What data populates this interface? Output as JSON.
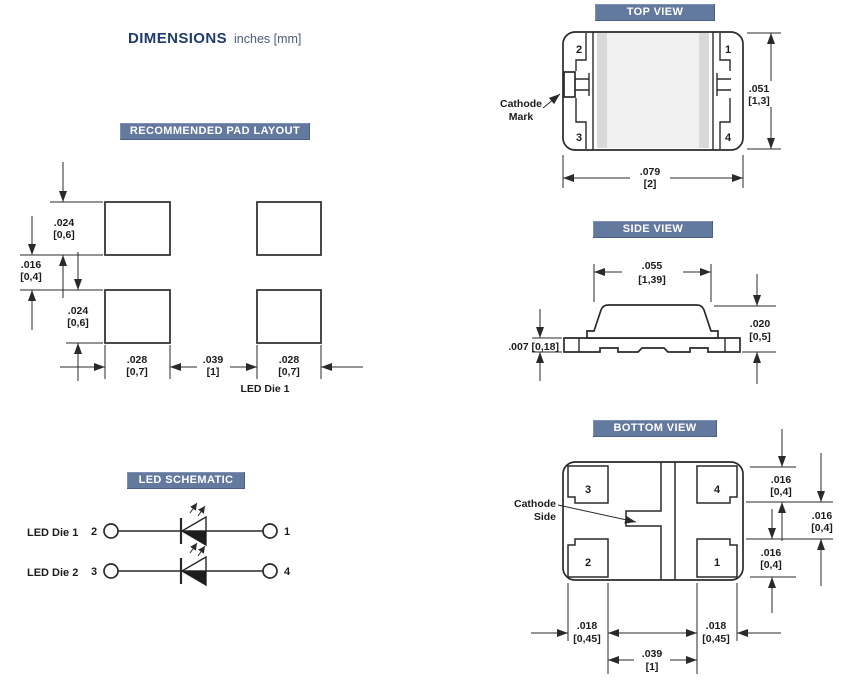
{
  "title": {
    "main": "DIMENSIONS",
    "sub": "inches [mm]"
  },
  "colors": {
    "badge_bg": "#64799e",
    "badge_text": "#ffffff",
    "title_main": "#1e3c6e",
    "title_sub": "#4a5d7a",
    "line_art": "#2a2a2a",
    "body_fill_light": "#f1f1f1",
    "body_fill_strip": "#d9d9d9"
  },
  "pad_layout": {
    "badge": "RECOMMENDED PAD LAYOUT",
    "note": "LED Die 1",
    "dims": {
      "pad_h_top": {
        "in": ".024",
        "mm": "[0,6]"
      },
      "row_gap": {
        "in": ".016",
        "mm": "[0,4]"
      },
      "pad_h_bot": {
        "in": ".024",
        "mm": "[0,6]"
      },
      "pad_w_left": {
        "in": ".028",
        "mm": "[0,7]"
      },
      "col_gap": {
        "in": ".039",
        "mm": "[1]"
      },
      "pad_w_right": {
        "in": ".028",
        "mm": "[0,7]"
      }
    }
  },
  "top_view": {
    "badge": "TOP VIEW",
    "pins": {
      "top_left": "2",
      "top_right": "1",
      "bottom_left": "3",
      "bottom_right": "4"
    },
    "callout": {
      "line1": "Cathode",
      "line2": "Mark"
    },
    "dims": {
      "height": {
        "in": ".051",
        "mm": "[1,3]"
      },
      "width": {
        "in": ".079",
        "mm": "[2]"
      }
    }
  },
  "side_view": {
    "badge": "SIDE VIEW",
    "dims": {
      "top_width": {
        "in": ".055",
        "mm": "[1,39]"
      },
      "base_thickness": {
        "text": ".007 [0,18]"
      },
      "body_height": {
        "in": ".020",
        "mm": "[0,5]"
      }
    }
  },
  "bottom_view": {
    "badge": "BOTTOM VIEW",
    "pins": {
      "top_left": "3",
      "top_right": "4",
      "bottom_left": "2",
      "bottom_right": "1"
    },
    "callout": {
      "line1": "Cathode",
      "line2": "Side"
    },
    "dims": {
      "pad_h_top": {
        "in": ".016",
        "mm": "[0,4]"
      },
      "pad_gap": {
        "in": ".016",
        "mm": "[0,4]"
      },
      "pad_h_bot": {
        "in": ".016",
        "mm": "[0,4]"
      },
      "pad_w_left": {
        "in": ".018",
        "mm": "[0,45]"
      },
      "pad_w_right": {
        "in": ".018",
        "mm": "[0,45]"
      },
      "center_gap": {
        "in": ".039",
        "mm": "[1]"
      }
    }
  },
  "schematic": {
    "badge": "LED SCHEMATIC",
    "rows": [
      {
        "label": "LED Die 1",
        "left_pin": "2",
        "right_pin": "1"
      },
      {
        "label": "LED Die 2",
        "left_pin": "3",
        "right_pin": "4"
      }
    ]
  }
}
